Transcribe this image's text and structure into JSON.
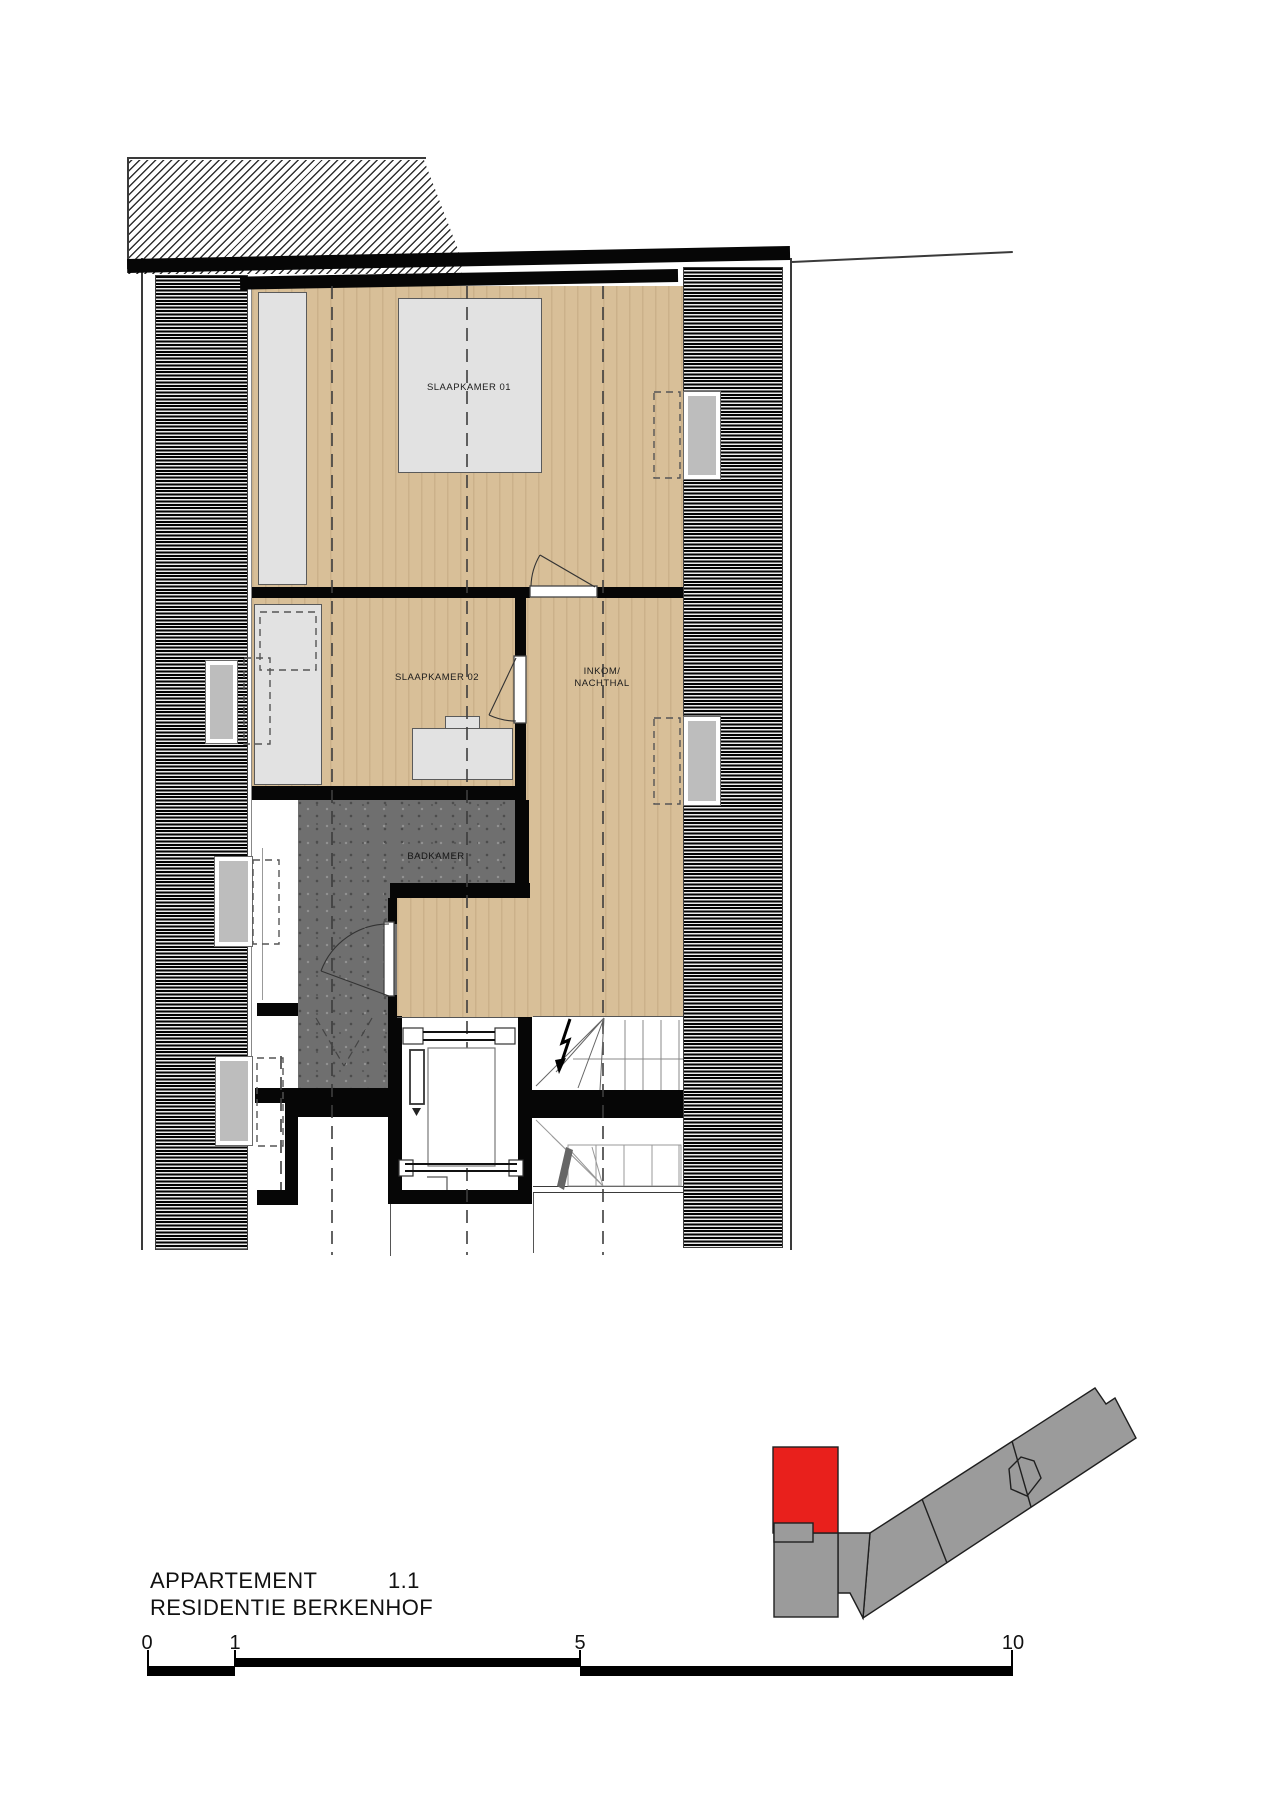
{
  "title": {
    "line1": "APPARTEMENT",
    "unit": "1.1",
    "line2": "RESIDENTIE BERKENHOF"
  },
  "rooms": {
    "bedroom1": "SLAAPKAMER 01",
    "bedroom2": "SLAAPKAMER 02",
    "hall_line1": "INKOM/",
    "hall_line2": "NACHTHAL",
    "bathroom": "BADKAMER"
  },
  "scale_bar": {
    "labels": [
      "0",
      "1",
      "5",
      "10"
    ]
  },
  "colors": {
    "wood_floor": "#d8bf98",
    "bathroom_floor": "#6f6f6f",
    "wall": "#060606",
    "furniture": "#e2e2e2",
    "window_glass": "#bdbdbd",
    "keymap_building": "#9b9b9b",
    "keymap_highlight": "#e9201c"
  },
  "key_map": {
    "highlighted_unit": "1.1"
  }
}
